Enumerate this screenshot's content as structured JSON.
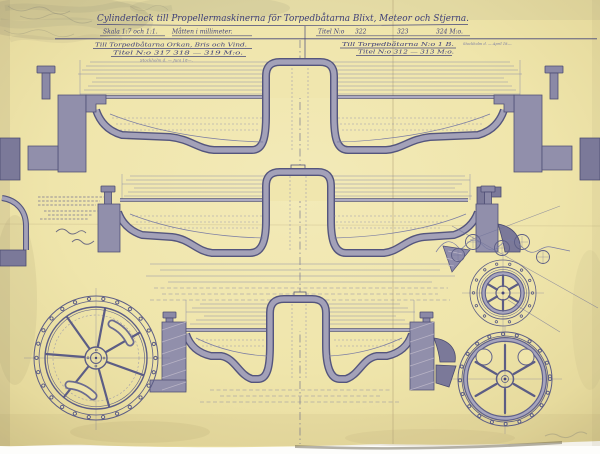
{
  "header": {
    "title": "Cylinderlock till Propellermaskinerna för Torpedbåtarna Blixt, Meteor och Stjerna.",
    "scale_note": "Skala 1:7 och 1:1.",
    "units_note": "Måtten i millimeter.",
    "titel_label": "Titel N:o",
    "titel_numbers": [
      "322",
      "323",
      "324 M:o."
    ],
    "left_column": {
      "ships_note": "Till Torpedbåtarna Orkan, Bris och Vind.",
      "titel_note": "Titel N:o 317  318  —  319 M:o.",
      "date_note": "Stockholm d. — Juni 18—."
    },
    "right_column": {
      "ships_note": "Till Torpedbåtarna N:o 1 B.",
      "titel_note": "Titel N:o 312 — 313 M:o.",
      "date_note": "Stockholm d. — April 18—."
    }
  },
  "colors": {
    "paper": "#efe5ab",
    "paper_light": "#f4ecbc",
    "paper_edge": "#cdbf8c",
    "ink": "#46477a",
    "ink_faint": "#8486ad",
    "metal_fill": "#a19fb8",
    "metal_dark": "#7b7999",
    "pencil": "#8f8b79"
  }
}
